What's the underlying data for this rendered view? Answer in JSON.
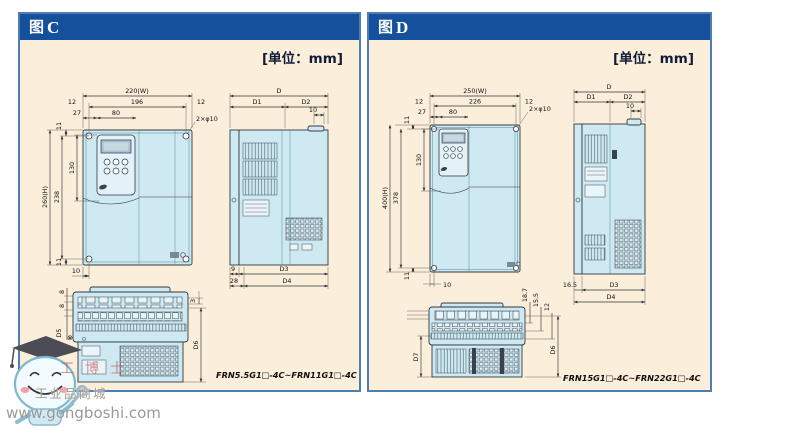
{
  "colors": {
    "header_bg": "#15509c",
    "panel_bg": "#fbeeda",
    "panel_border": "#4f7db2",
    "device_fill": "#cfe9f2",
    "line": "#2f3a40",
    "watermark_red": "#be3737"
  },
  "watermark": {
    "url": "www.gongboshi.com",
    "shop": "工业品商城",
    "red_text": "工博士"
  },
  "panel_c": {
    "title_prefix": "图",
    "title_letter": "C",
    "unit_label": "[单位：mm]",
    "model_range": "FRN5.5G1□-4C~FRN11G1□-4C",
    "front": {
      "w": "220(W)",
      "wp": "196",
      "ml": "12",
      "mr": "12",
      "ko": "27",
      "kw": "80",
      "phi": "2×φ10",
      "to": "11",
      "h": "260(H)",
      "hp": "238",
      "kh": "130",
      "bo": "11",
      "hx": "10"
    },
    "side": {
      "d": "D",
      "d1": "D1",
      "d2": "D2",
      "t10": "10",
      "b1": "9",
      "d3": "D3",
      "b2": "28",
      "d4": "D4"
    },
    "bottom": {
      "s1": "8",
      "s2": "8",
      "d5": "D5",
      "sym": "⊗",
      "s3": "3",
      "d6": "D6"
    }
  },
  "panel_d": {
    "title_prefix": "图",
    "title_letter": "D",
    "unit_label": "[单位：mm]",
    "model_range": "FRN15G1□-4C~FRN22G1□-4C",
    "front": {
      "w": "250(W)",
      "wp": "226",
      "ml": "12",
      "mr": "12",
      "ko": "27",
      "kw": "80",
      "phi": "2×φ10",
      "to": "11",
      "h": "400(H)",
      "hp": "378",
      "kh": "130",
      "bo": "11",
      "hx": "10"
    },
    "side": {
      "d": "D",
      "d1": "D1",
      "d2": "D2",
      "t10": "10",
      "b1": "16.5",
      "d3": "D3",
      "d4": "D4"
    },
    "bottom": {
      "s1": "18.7",
      "s2": "15.5",
      "s3": "12",
      "d6": "D6",
      "d7": "D7"
    }
  }
}
